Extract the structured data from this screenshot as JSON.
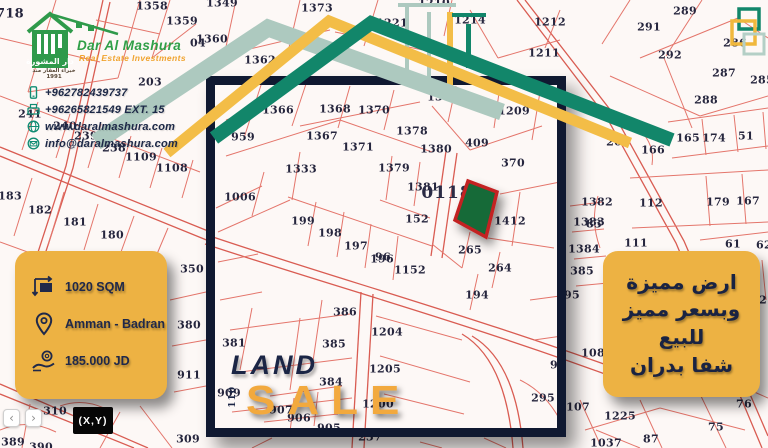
{
  "logo": {
    "brand": "Dar Al Mashura",
    "tagline": "Real Estate Investments",
    "house_label": "دار المشورة",
    "arabic_small": "خبراء العقار منذ 1991"
  },
  "contact": {
    "items": [
      {
        "icon": "mobile-icon",
        "text": "+962782439737"
      },
      {
        "icon": "fax-icon",
        "text": "+96265821549 EXT. 15"
      },
      {
        "icon": "globe-icon",
        "text": "www.daralmashura.com"
      },
      {
        "icon": "email-icon",
        "text": "info@daralmashura.com"
      }
    ]
  },
  "info_card": {
    "area": "1020 SQM",
    "location": "Amman - Badran",
    "price": "185.000 JD"
  },
  "arabic_card": {
    "lines": [
      "ارض مميزة",
      "وبسعر مميز",
      "للبيع",
      "شفا بدران"
    ]
  },
  "sale_banner": {
    "land": "LAND",
    "sale": "SALE",
    "vertical_number": "110"
  },
  "map_controls": {
    "prev": "‹",
    "next": "›",
    "coords_label": "(X,Y)"
  },
  "colors": {
    "card_yellow": "#edb243",
    "navy": "#1b2545",
    "teal_band": "#12866a",
    "sage_band": "#adc9bf",
    "yellow_band": "#f3bd47",
    "parcel_green": "#156a38",
    "parcel_red_border": "#c32222",
    "map_line_red": "#e2695f",
    "brand_green": "#2f9f47",
    "brand_orange": "#f0a32e"
  },
  "map": {
    "block_label": "0118",
    "parcel_numbers": [
      {
        "label": "718",
        "x": 10,
        "y": 14,
        "size": 13
      },
      {
        "label": "1358",
        "x": 152,
        "y": 6
      },
      {
        "label": "1359",
        "x": 182,
        "y": 21
      },
      {
        "label": "1349",
        "x": 222,
        "y": 3
      },
      {
        "label": "1360",
        "x": 212,
        "y": 39
      },
      {
        "label": "1373",
        "x": 317,
        "y": 8
      },
      {
        "label": "1362",
        "x": 260,
        "y": 60
      },
      {
        "label": "1221",
        "x": 392,
        "y": 23
      },
      {
        "label": "1210",
        "x": 434,
        "y": 3
      },
      {
        "label": "1214",
        "x": 470,
        "y": 20
      },
      {
        "label": "1212",
        "x": 550,
        "y": 22
      },
      {
        "label": "1211",
        "x": 544,
        "y": 53
      },
      {
        "label": "289",
        "x": 685,
        "y": 11
      },
      {
        "label": "291",
        "x": 649,
        "y": 27
      },
      {
        "label": "292",
        "x": 670,
        "y": 55
      },
      {
        "label": "286",
        "x": 735,
        "y": 43
      },
      {
        "label": "287",
        "x": 724,
        "y": 73
      },
      {
        "label": "285",
        "x": 762,
        "y": 80
      },
      {
        "label": "288",
        "x": 706,
        "y": 100
      },
      {
        "label": "203",
        "x": 150,
        "y": 82
      },
      {
        "label": "04",
        "x": 198,
        "y": 43
      },
      {
        "label": "1377",
        "x": 443,
        "y": 97
      },
      {
        "label": "1209",
        "x": 514,
        "y": 111
      },
      {
        "label": "959",
        "x": 243,
        "y": 137
      },
      {
        "label": "1366",
        "x": 278,
        "y": 110
      },
      {
        "label": "1368",
        "x": 335,
        "y": 109
      },
      {
        "label": "1370",
        "x": 374,
        "y": 110
      },
      {
        "label": "1367",
        "x": 322,
        "y": 136
      },
      {
        "label": "1371",
        "x": 358,
        "y": 147
      },
      {
        "label": "1378",
        "x": 412,
        "y": 131
      },
      {
        "label": "1380",
        "x": 436,
        "y": 149
      },
      {
        "label": "409",
        "x": 477,
        "y": 143
      },
      {
        "label": "370",
        "x": 513,
        "y": 163
      },
      {
        "label": "1379",
        "x": 394,
        "y": 168
      },
      {
        "label": "1381",
        "x": 423,
        "y": 187
      },
      {
        "label": "152",
        "x": 417,
        "y": 219
      },
      {
        "label": "1412",
        "x": 510,
        "y": 221
      },
      {
        "label": "1383",
        "x": 589,
        "y": 222
      },
      {
        "label": "1384",
        "x": 584,
        "y": 249
      },
      {
        "label": "385",
        "x": 582,
        "y": 271
      },
      {
        "label": "95",
        "x": 572,
        "y": 295
      },
      {
        "label": "265",
        "x": 470,
        "y": 250
      },
      {
        "label": "264",
        "x": 500,
        "y": 268
      },
      {
        "label": "194",
        "x": 477,
        "y": 295
      },
      {
        "label": "1152",
        "x": 410,
        "y": 270
      },
      {
        "label": "96",
        "x": 383,
        "y": 257
      },
      {
        "label": "1333",
        "x": 301,
        "y": 169
      },
      {
        "label": "1006",
        "x": 240,
        "y": 197
      },
      {
        "label": "199",
        "x": 303,
        "y": 221
      },
      {
        "label": "198",
        "x": 330,
        "y": 233
      },
      {
        "label": "197",
        "x": 356,
        "y": 246
      },
      {
        "label": "196",
        "x": 382,
        "y": 259
      },
      {
        "label": "241",
        "x": 30,
        "y": 114
      },
      {
        "label": "240",
        "x": 65,
        "y": 126
      },
      {
        "label": "239",
        "x": 86,
        "y": 136
      },
      {
        "label": "238",
        "x": 114,
        "y": 148
      },
      {
        "label": "1109",
        "x": 141,
        "y": 157
      },
      {
        "label": "1108",
        "x": 172,
        "y": 168
      },
      {
        "label": "183",
        "x": 10,
        "y": 196
      },
      {
        "label": "182",
        "x": 40,
        "y": 210
      },
      {
        "label": "181",
        "x": 75,
        "y": 222
      },
      {
        "label": "180",
        "x": 112,
        "y": 235
      },
      {
        "label": "350",
        "x": 192,
        "y": 269
      },
      {
        "label": "380",
        "x": 189,
        "y": 325
      },
      {
        "label": "911",
        "x": 189,
        "y": 375
      },
      {
        "label": "310",
        "x": 55,
        "y": 411
      },
      {
        "label": "309",
        "x": 188,
        "y": 439
      },
      {
        "label": "389",
        "x": 13,
        "y": 442
      },
      {
        "label": "390",
        "x": 41,
        "y": 447
      },
      {
        "label": "381",
        "x": 234,
        "y": 343
      },
      {
        "label": "385",
        "x": 334,
        "y": 344
      },
      {
        "label": "386",
        "x": 345,
        "y": 312
      },
      {
        "label": "1204",
        "x": 387,
        "y": 332
      },
      {
        "label": "1205",
        "x": 385,
        "y": 369
      },
      {
        "label": "384",
        "x": 331,
        "y": 382
      },
      {
        "label": "1200",
        "x": 378,
        "y": 404
      },
      {
        "label": "907",
        "x": 281,
        "y": 410
      },
      {
        "label": "906",
        "x": 299,
        "y": 418
      },
      {
        "label": "905",
        "x": 329,
        "y": 428
      },
      {
        "label": "909",
        "x": 229,
        "y": 393
      },
      {
        "label": "237",
        "x": 370,
        "y": 437
      },
      {
        "label": "295",
        "x": 543,
        "y": 398
      },
      {
        "label": "107",
        "x": 578,
        "y": 407
      },
      {
        "label": "99",
        "x": 558,
        "y": 365
      },
      {
        "label": "108",
        "x": 593,
        "y": 353
      },
      {
        "label": "111",
        "x": 636,
        "y": 243
      },
      {
        "label": "61",
        "x": 733,
        "y": 244
      },
      {
        "label": "62",
        "x": 764,
        "y": 245
      },
      {
        "label": "72",
        "x": 759,
        "y": 300
      },
      {
        "label": "83",
        "x": 594,
        "y": 224
      },
      {
        "label": "1382",
        "x": 597,
        "y": 202
      },
      {
        "label": "112",
        "x": 651,
        "y": 203
      },
      {
        "label": "179",
        "x": 718,
        "y": 202
      },
      {
        "label": "167",
        "x": 748,
        "y": 201
      },
      {
        "label": "166",
        "x": 653,
        "y": 150
      },
      {
        "label": "268",
        "x": 618,
        "y": 142
      },
      {
        "label": "165",
        "x": 688,
        "y": 138
      },
      {
        "label": "174",
        "x": 714,
        "y": 138
      },
      {
        "label": "51",
        "x": 746,
        "y": 136
      },
      {
        "label": "1225",
        "x": 620,
        "y": 416
      },
      {
        "label": "1037",
        "x": 606,
        "y": 443
      },
      {
        "label": "87",
        "x": 651,
        "y": 439
      },
      {
        "label": "75",
        "x": 716,
        "y": 427
      },
      {
        "label": "76",
        "x": 744,
        "y": 404
      }
    ]
  }
}
